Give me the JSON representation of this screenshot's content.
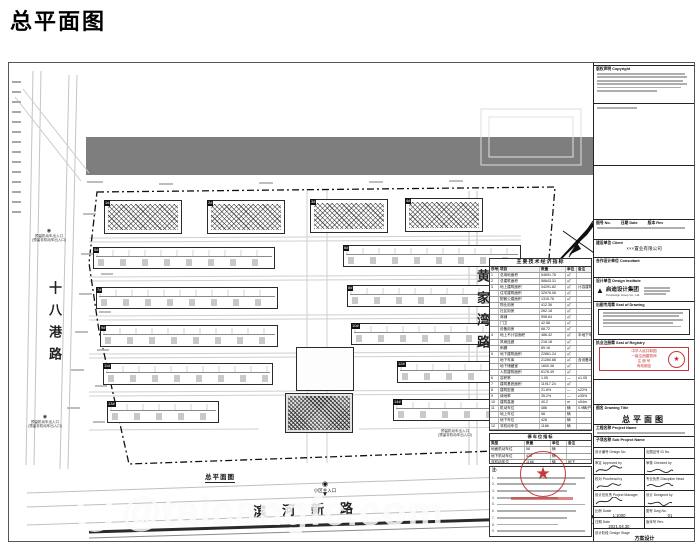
{
  "page": {
    "title": "总平面图",
    "watermark": "@taicangfc.com"
  },
  "roads": {
    "left": "十八港路",
    "right": "黄家湾路",
    "bottom": "滨河新路"
  },
  "plan": {
    "caption": "总平面图",
    "main_entrance": "小区主入口",
    "left_entrance_1": "预留机动车出入口",
    "left_entrance_1b": "(预留非机动车出入口)",
    "left_entrance_2": "预留机动车出入口",
    "left_entrance_2b": "(预留非机动车出入口)",
    "bottom_entrance": "预留机动车出入口",
    "bottom_entrance_b": "(预留非机动车出入口)"
  },
  "buildings": [
    {
      "id": "1#",
      "type": "hatched",
      "x": 95,
      "y": 137,
      "w": 78,
      "h": 34
    },
    {
      "id": "2#",
      "type": "hatched",
      "x": 198,
      "y": 137,
      "w": 78,
      "h": 34
    },
    {
      "id": "3#",
      "type": "hatched",
      "x": 301,
      "y": 136,
      "w": 78,
      "h": 34
    },
    {
      "id": "4#",
      "type": "hatched",
      "x": 396,
      "y": 135,
      "w": 78,
      "h": 34
    },
    {
      "id": "5#",
      "type": "slab",
      "x": 84,
      "y": 184,
      "w": 182,
      "h": 22
    },
    {
      "id": "6#",
      "type": "slab",
      "x": 334,
      "y": 182,
      "w": 178,
      "h": 22
    },
    {
      "id": "7#",
      "type": "slab",
      "x": 87,
      "y": 224,
      "w": 182,
      "h": 22
    },
    {
      "id": "8#",
      "type": "slab",
      "x": 338,
      "y": 222,
      "w": 178,
      "h": 22
    },
    {
      "id": "9#",
      "type": "slab",
      "x": 91,
      "y": 262,
      "w": 178,
      "h": 22
    },
    {
      "id": "10#",
      "type": "slab",
      "x": 342,
      "y": 260,
      "w": 172,
      "h": 22
    },
    {
      "id": "11#",
      "type": "slab",
      "x": 94,
      "y": 300,
      "w": 170,
      "h": 22
    },
    {
      "id": "12#",
      "type": "slab",
      "x": 388,
      "y": 298,
      "w": 128,
      "h": 22
    },
    {
      "id": "13#",
      "type": "slab",
      "x": 98,
      "y": 338,
      "w": 112,
      "h": 22
    },
    {
      "id": "14#",
      "type": "slab",
      "x": 384,
      "y": 336,
      "w": 130,
      "h": 22
    },
    {
      "id": "",
      "type": "outline",
      "x": 287,
      "y": 284,
      "w": 58,
      "h": 44
    },
    {
      "id": "",
      "type": "hatched-dense",
      "x": 276,
      "y": 330,
      "w": 68,
      "h": 40
    }
  ],
  "indicators": {
    "title": "主要技术经济指标",
    "headers": [
      "序号",
      "项目",
      "数量",
      "单位",
      "备注"
    ],
    "rows": [
      [
        "1",
        "总用地面积",
        "54691.76",
        "㎡",
        ""
      ],
      [
        "2",
        "总建筑面积",
        "58643.31",
        "㎡",
        ""
      ],
      [
        "3",
        "地上建筑面积",
        "34291.82",
        "㎡",
        "计容建筑面积"
      ],
      [
        "",
        "住宅建筑面积",
        "32976.06",
        "㎡",
        ""
      ],
      [
        "",
        "配套公建面积",
        "1315.76",
        "㎡",
        ""
      ],
      [
        "",
        "物业用房",
        "412.36",
        "㎡",
        ""
      ],
      [
        "",
        "社区用房",
        "262.18",
        "㎡",
        ""
      ],
      [
        "",
        "商铺",
        "598.64",
        "㎡",
        ""
      ],
      [
        "",
        "门卫",
        "42.58",
        "㎡",
        ""
      ],
      [
        "",
        "设备用房",
        "68.72",
        "㎡",
        ""
      ],
      [
        "4",
        "地上不计容面积",
        "486.42",
        "㎡",
        "半地下车库"
      ],
      [
        "",
        "风雨连廊",
        "216.18",
        "㎡",
        ""
      ],
      [
        "",
        "雨棚",
        "89.16",
        "㎡",
        ""
      ],
      [
        "5",
        "地下建筑面积",
        "22861.24",
        "㎡",
        ""
      ],
      [
        "",
        "地下车库",
        "21260.86",
        "㎡",
        "含设备用房"
      ],
      [
        "",
        "地下储藏室",
        "1600.38",
        "㎡",
        ""
      ],
      [
        "",
        "人防建筑面积",
        "6176.49",
        "㎡",
        ""
      ],
      [
        "6",
        "容积率",
        "1.05",
        "—",
        "≤1.05"
      ],
      [
        "7",
        "建筑基底面积",
        "11917.24",
        "㎡",
        ""
      ],
      [
        "8",
        "建筑密度",
        "21.8%",
        "—",
        "≤22%"
      ],
      [
        "9",
        "绿地率",
        "35.2%",
        "—",
        "≥35%"
      ],
      [
        "10",
        "建筑高度",
        "40.2",
        "m",
        "≤54m"
      ],
      [
        "11",
        "机动车位",
        "486",
        "辆",
        "0.9辆/户"
      ],
      [
        "",
        "地上车位",
        "58",
        "辆",
        ""
      ],
      [
        "",
        "地下车位",
        "428",
        "辆",
        ""
      ],
      [
        "12",
        "非机动车位",
        "1186",
        "辆",
        ""
      ],
      [
        "13",
        "总户数",
        "540",
        "户",
        ""
      ],
      [
        "14",
        "居住人数",
        "1728",
        "人",
        "3.2人/户"
      ],
      [
        "15",
        "机动车出入口",
        "2",
        "个",
        ""
      ],
      [
        "16",
        "非机动车出入口",
        "2",
        "个",
        ""
      ]
    ]
  },
  "parking": {
    "title": "停车位指标",
    "headers": [
      "类型",
      "数量",
      "单位",
      "备注"
    ],
    "rows": [
      [
        "地面机动车位",
        "58",
        "辆",
        ""
      ],
      [
        "地下机动车位",
        "428",
        "辆",
        ""
      ],
      [
        "非机动车位",
        "1186",
        "辆",
        "地下"
      ]
    ]
  },
  "notes": {
    "label": "注:",
    "count": 12
  },
  "titleblock": {
    "copyright_label": "版权声明 Copyright",
    "catalog_no": "图号 No.",
    "catalog_date": "日期 Date",
    "catalog_rev": "版本 Rev",
    "client_label": "建设单位 Client",
    "client_name": "×××置业有限公司",
    "consultant_label": "合作设计单位 Consultant",
    "institute_label": "设计单位 Design Institute",
    "institute_name": "启迪设计集团",
    "institute_en": "Tus-Design Group Co., Ltd.",
    "plot_seal_label": "出图专用章 Seal of Drawing",
    "registry_label": "执业注册章 Seal of Registry",
    "registry_line1": "中华人民共和国",
    "registry_line2": "一级注册建筑师",
    "registry_no": "注 册 号",
    "registry_valid": "有效期至",
    "drawing_title_label": "图名 Drawing Title",
    "drawing_title": "总平面图",
    "project_label": "工程名称 Project Name",
    "subproject_label": "子项名称 Sub Project Name",
    "design_no_label": "设计编号 Design No.",
    "id_no_label": "出图证号 ID No.",
    "approved": "审定 Approved by",
    "checked": "审核 Checked by",
    "proof": "校对 Proofread by",
    "discipline": "专业负责 Discipline Head",
    "chief": "设计总负责 Project Manager",
    "designer": "设计 Designed by",
    "scale_label": "比例 Scale",
    "scale_value": "1:1000",
    "dwg_no_label": "图号 Dwg No.",
    "dwg_no_value": "01",
    "date_label": "日期 Date",
    "date_value": "2021.04.30",
    "rev_label": "版本号 Rev.",
    "stage_label": "设计阶段 Design Stage",
    "stage_value": "方案设计"
  }
}
